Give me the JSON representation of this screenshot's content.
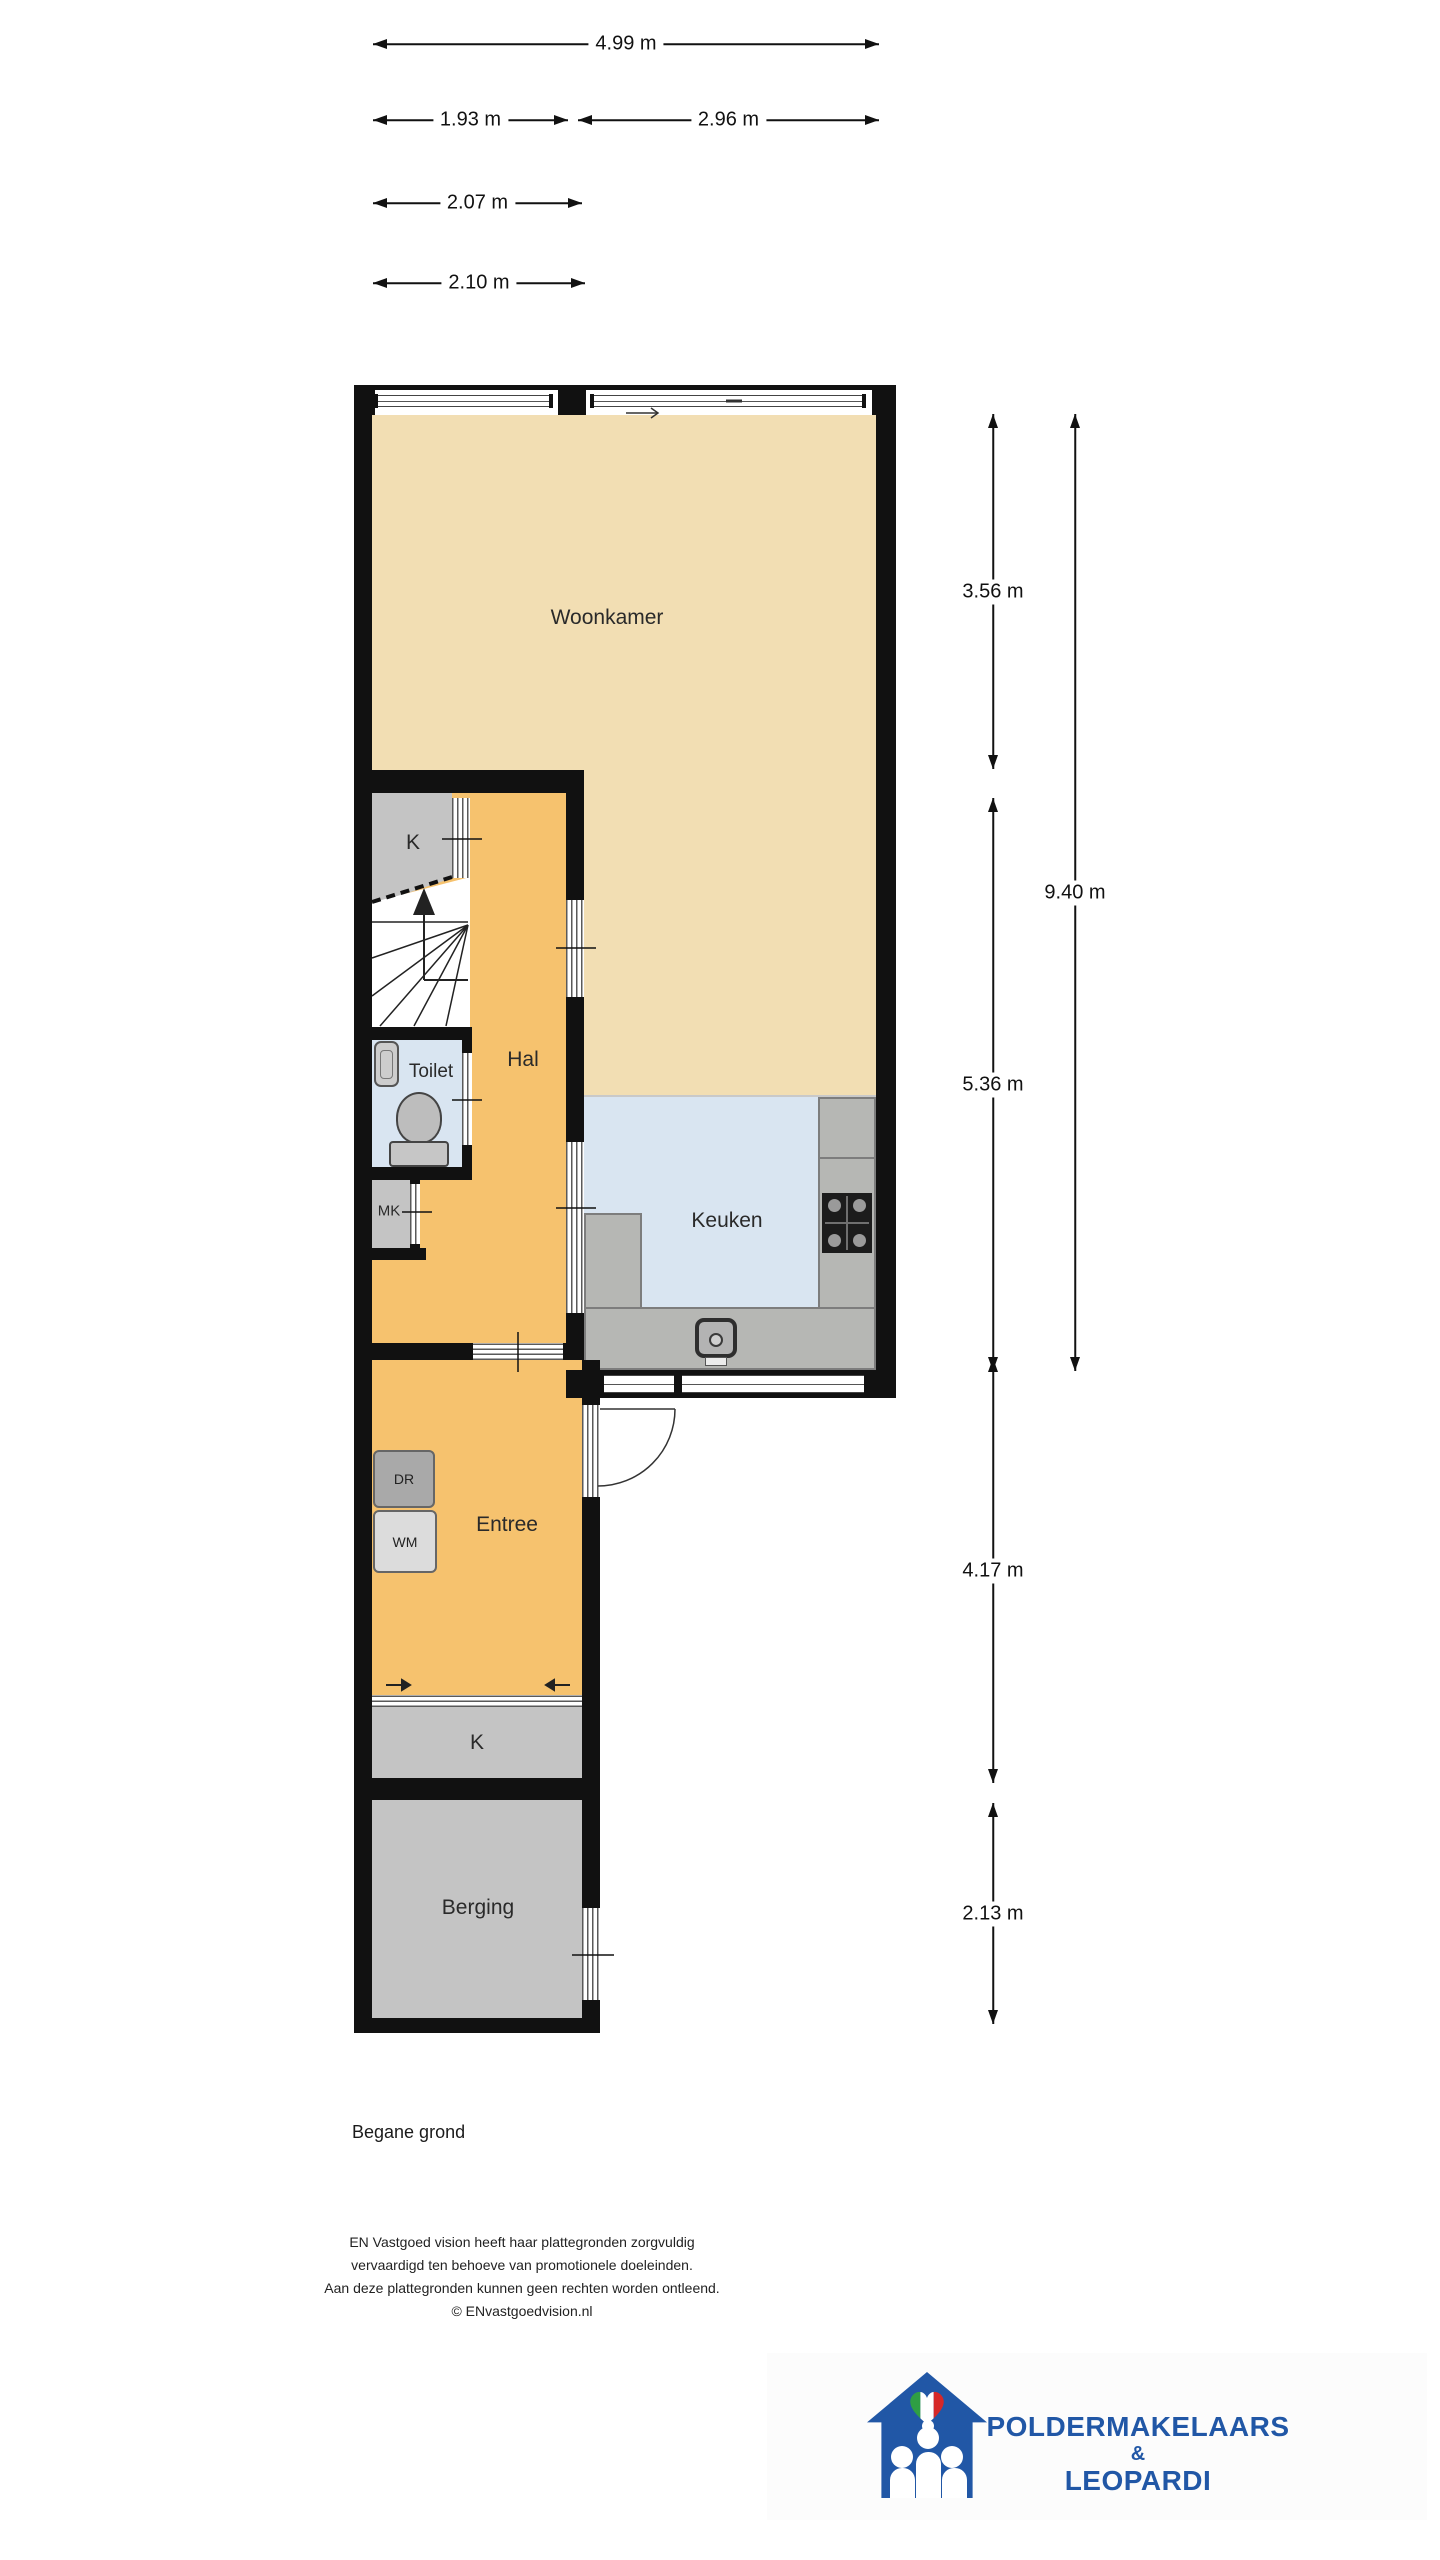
{
  "dimensions": {
    "top": [
      "4.99 m",
      "1.93 m",
      "2.96 m",
      "2.07 m",
      "2.10 m"
    ],
    "right": [
      "3.56 m",
      "9.40 m",
      "5.36 m",
      "4.17 m",
      "2.13 m"
    ]
  },
  "rooms": {
    "woonkamer": "Woonkamer",
    "hal": "Hal",
    "toilet": "Toilet",
    "mk": "MK",
    "keuken": "Keuken",
    "entree": "Entree",
    "kast_top": "K",
    "kast_bottom": "K",
    "berging": "Berging"
  },
  "appliances": {
    "dr": "DR",
    "wm": "WM"
  },
  "footer": {
    "title": "Begane grond",
    "disclaimer": [
      "EN Vastgoed vision heeft haar plattegronden zorgvuldig",
      "vervaardigd ten behoeve van promotionele doeleinden.",
      "Aan deze plattegronden kunnen geen rechten worden ontleend."
    ],
    "copyright": "© ENvastgoedvision.nl"
  },
  "logo": {
    "name_top": "POLDERMAKELAARS",
    "amp": "&",
    "name_bottom": "LEOPARDI"
  },
  "colors": {
    "wall": "#111111",
    "woonkamer_floor": "#f2deb3",
    "hal_floor": "#f6c26e",
    "wet_floor": "#d9e5f1",
    "storage_floor": "#c4c4c4",
    "counter": "#b6b7b4",
    "logo_blue": "#2157a6",
    "flag_green": "#2f9e44",
    "flag_red": "#d62828"
  }
}
